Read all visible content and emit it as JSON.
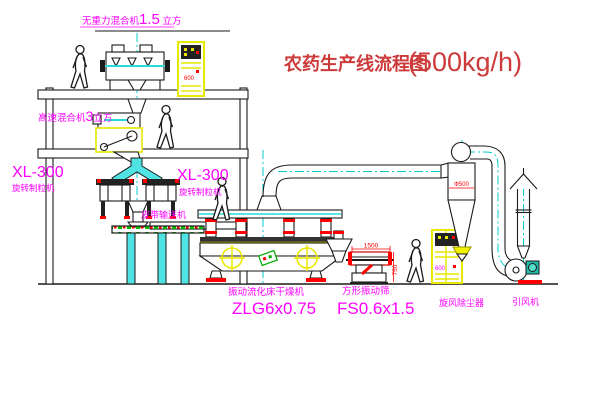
{
  "title": {
    "name": "农药生产线流程图",
    "capacity": "(500kg/h)"
  },
  "eq": {
    "gravity_free_mixer": {
      "name": "无重力混合机",
      "size": "1.5",
      "unit": " 立方"
    },
    "high_speed_mixer": {
      "name": "高速混合机",
      "size": "3",
      "unit": "立方"
    },
    "granulator_left": {
      "model": "XL-300",
      "name": "旋转制粒机"
    },
    "granulator_right": {
      "model": "XL-300",
      "name": "旋转制粒机"
    },
    "belt_conveyor": {
      "name": "皮带输送机"
    },
    "fluid_bed_dryer": {
      "name": "振动流化床干燥机",
      "model": "ZLG6x0.75"
    },
    "vibrating_screen": {
      "name": "方形振动筛",
      "model": "FS0.6x1.5"
    },
    "cyclone": {
      "name": "旋风除尘器"
    },
    "draft_fan": {
      "name": "引风机"
    }
  },
  "dims": {
    "cyclone_diameter": "Φ500",
    "screen_length": "1500",
    "screen_height": "750",
    "cabinet1_mark": "600",
    "cabinet2_mark": "600"
  },
  "colors": {
    "label": "#ff00ff",
    "title": "#cc3a3a",
    "dimension": "#ff0000",
    "centerline": "#00cccc",
    "accent": "#e8e800"
  }
}
